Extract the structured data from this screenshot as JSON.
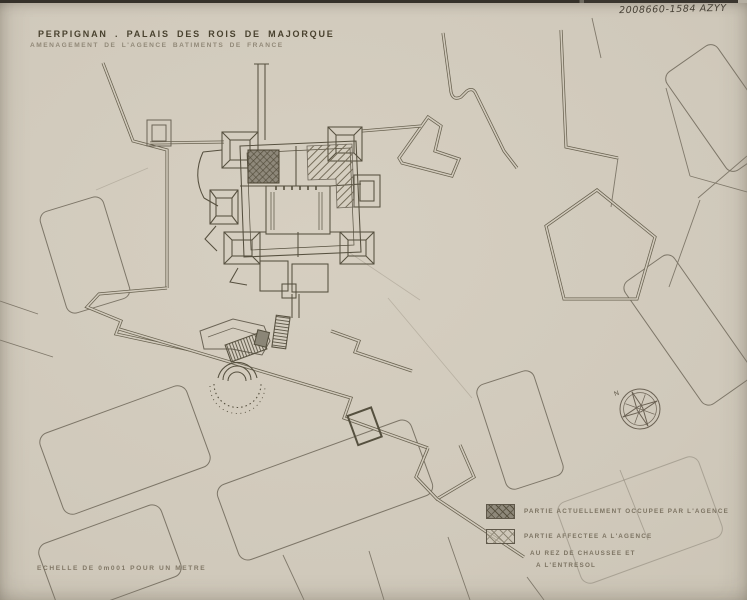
{
  "archive_ref": "2008660-1584 AZYY",
  "title": {
    "line1": "PERPIGNAN . PALAIS DES ROIS DE MAJORQUE",
    "line2": "AMENAGEMENT DE L'AGENCE BATIMENTS DE FRANCE"
  },
  "scale_note": "ECHELLE DE 0m001 POUR UN METRE",
  "legend": {
    "items": [
      {
        "swatch": "dark-crosshatch",
        "lines": [
          "PARTIE ACTUELLEMENT OCCUPEE PAR L'AGENCE"
        ]
      },
      {
        "swatch": "light-crosshatch",
        "lines": [
          "PARTIE AFFECTEE A L'AGENCE",
          "AU REZ DE CHAUSSEE ET",
          "A L'ENTRESOL"
        ]
      }
    ]
  },
  "compass": {
    "north_label": "N"
  },
  "colors": {
    "paper": "#d0c9bb",
    "ink": "#6b6456",
    "ink_dark": "#55503f",
    "occupied_fill": "#8e887a",
    "text_dark": "#49422f",
    "text_light": "#7c7361"
  }
}
